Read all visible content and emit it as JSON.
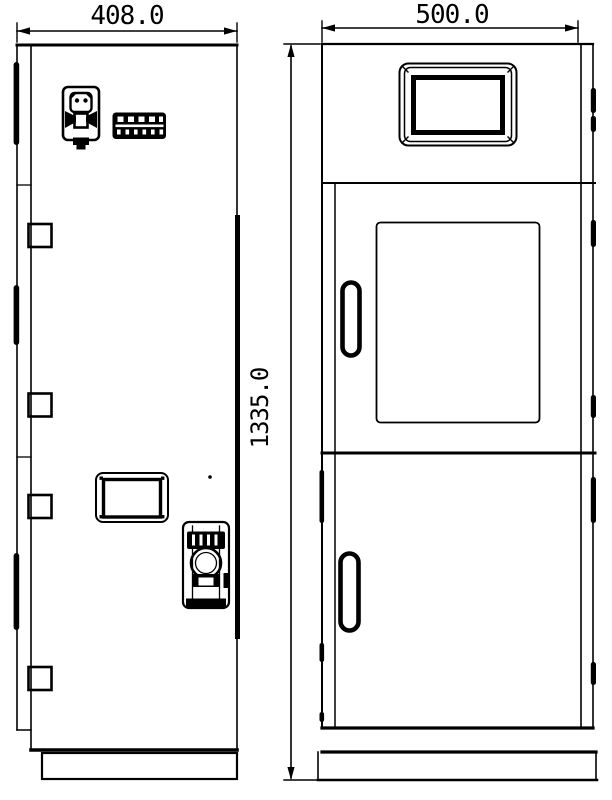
{
  "drawing": {
    "type": "engineering-two-view-cabinet-drawing",
    "colors": {
      "background": "#ffffff",
      "line": "#000000"
    },
    "side_view": {
      "width_dimension": "408.0",
      "icons": [
        "gas-sensor-icon",
        "terminal-block-icon",
        "access-panel",
        "pressure-regulator-icon",
        "hinge-icon",
        "gasket-strip-icon"
      ]
    },
    "front_view": {
      "width_dimension": "500.0",
      "height_dimension": "1335.0",
      "icons": [
        "hmi-screen",
        "inspection-window",
        "door-handle",
        "hinge-bump-icon",
        "cabinet-base"
      ]
    }
  }
}
